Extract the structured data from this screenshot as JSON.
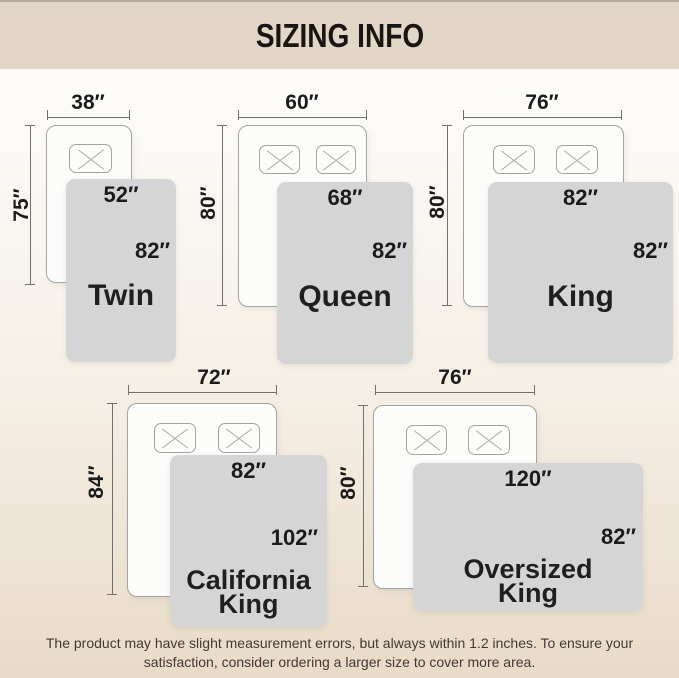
{
  "header": {
    "title": "SIZING INFO"
  },
  "sizes": {
    "twin": {
      "name": "Twin",
      "bed_width": "38″",
      "bed_length": "75″",
      "blanket_width": "52″",
      "blanket_length": "82″"
    },
    "queen": {
      "name": "Queen",
      "bed_width": "60″",
      "bed_length": "80″",
      "blanket_width": "68″",
      "blanket_length": "82″"
    },
    "king": {
      "name": "King",
      "bed_width": "76″",
      "bed_length": "80″",
      "blanket_width": "82″",
      "blanket_length": "82″"
    },
    "cal_king": {
      "name_line1": "California",
      "name_line2": "King",
      "bed_width": "72″",
      "bed_length": "84″",
      "blanket_width": "82″",
      "blanket_length": "102″"
    },
    "oversized_king": {
      "name_line1": "Oversized",
      "name_line2": "King",
      "bed_width": "76″",
      "bed_length": "80″",
      "blanket_width": "120″",
      "blanket_length": "82″"
    }
  },
  "footer": {
    "line1": "The product may have slight measurement errors, but always within 1.2 inches. To ensure your",
    "line2": "satisfaction, consider ordering a larger size to cover more area."
  },
  "colors": {
    "header_bg": "#e2d7c6",
    "page_top": "#fdfcfa",
    "page_mid": "#f6f0e7",
    "page_bottom": "#e8dbc7",
    "title_color": "#191511",
    "blanket_fill": "#d5d5d5",
    "bed_fill": "#fcfcfb",
    "bed_border": "#a3a3a1",
    "dim_line": "#70706e",
    "label_color": "#1b1b1b",
    "footer_text": "#3f3a33"
  }
}
